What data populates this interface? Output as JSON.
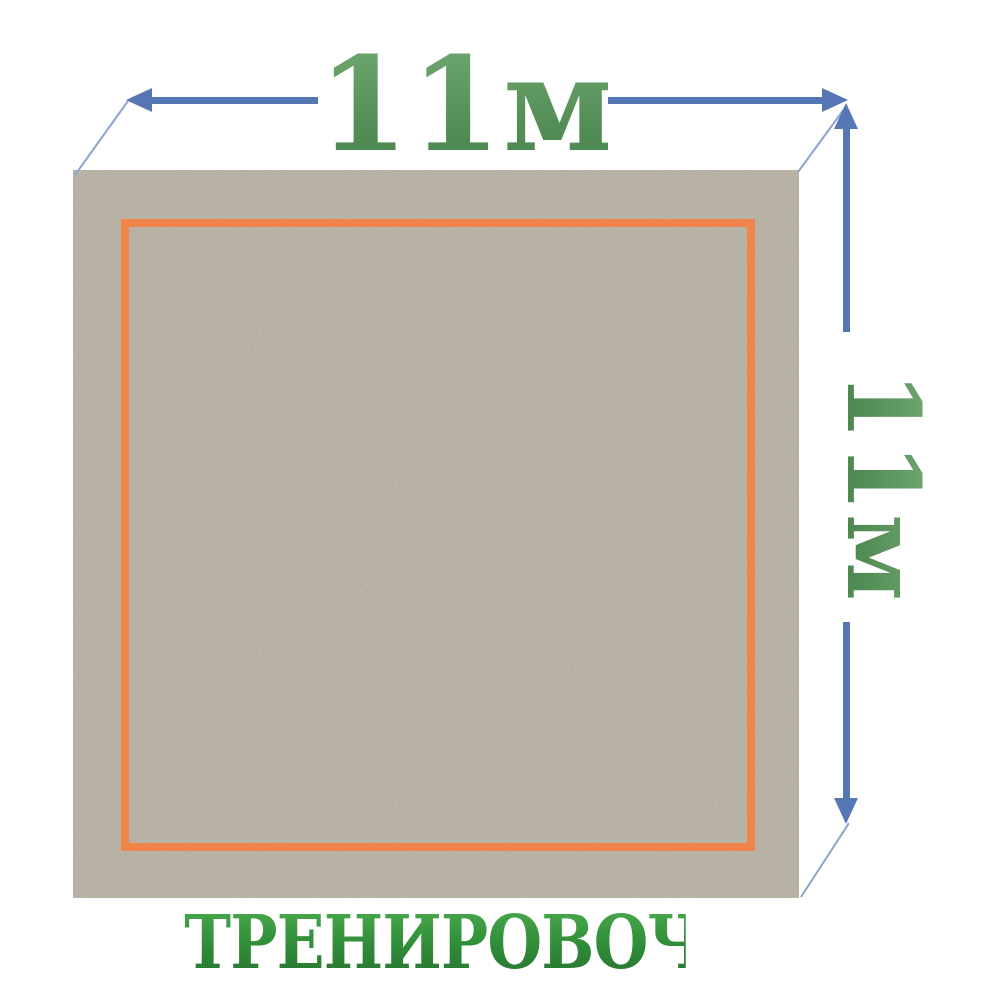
{
  "diagram": {
    "product_title": "ТРЕНИРОВОЧНЫЙ",
    "dimensions": {
      "width": {
        "label": "11м",
        "meters": 11
      },
      "height": {
        "label": "11м",
        "meters": 11
      }
    },
    "colors": {
      "background": "#ffffff",
      "mat_surface": "#b7b09f",
      "boundary_line_orange": "#f0854a",
      "dimension_arrow_blue": "#5578b4",
      "leader_line_blue": "#8ca4cd",
      "label_green_light": "#6fa971",
      "label_green_dark": "#47854c",
      "title_green_light": "#4aab4f",
      "title_green_dark": "#277530"
    }
  }
}
